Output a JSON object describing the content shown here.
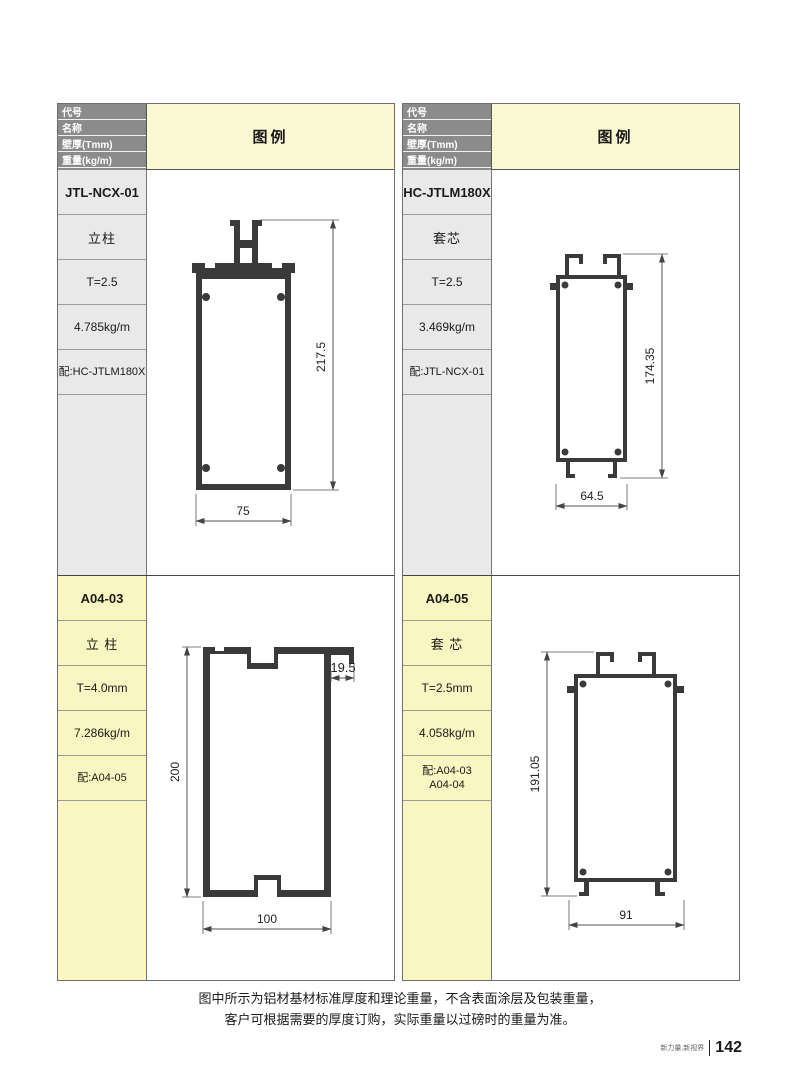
{
  "colors": {
    "header_gray": "#8b8b8b",
    "legend_yellow": "#FBF9D2",
    "cell_gray": "#e9e9e9",
    "cell_yellow": "#FAF6C2",
    "profile_ink": "#3a3a3a"
  },
  "header": {
    "rows": [
      "代号",
      "名称",
      "壁厚(Tmm)",
      "重量(kg/m)",
      "配套"
    ],
    "legend": "图例"
  },
  "panels": {
    "left": {
      "top": {
        "code": "JTL-NCX-01",
        "name": "立柱",
        "thickness": "T=2.5",
        "weight": "4.785kg/m",
        "match": "配:HC-JTLM180X",
        "dim_height": "217.5",
        "dim_width": "75"
      },
      "bottom": {
        "code": "A04-03",
        "name": "立 柱",
        "thickness": "T=4.0mm",
        "weight": "7.286kg/m",
        "match": "配:A04-05",
        "dim_height": "200",
        "dim_width": "100",
        "dim_lip": "19.5"
      }
    },
    "right": {
      "top": {
        "code": "HC-JTLM180X",
        "name": "套芯",
        "thickness": "T=2.5",
        "weight": "3.469kg/m",
        "match": "配:JTL-NCX-01",
        "dim_height": "174.35",
        "dim_width": "64.5"
      },
      "bottom": {
        "code": "A04-05",
        "name": "套 芯",
        "thickness": "T=2.5mm",
        "weight": "4.058kg/m",
        "match_line1": "配:A04-03",
        "match_line2": "A04-04",
        "dim_height": "191.05",
        "dim_width": "91"
      }
    }
  },
  "footer": {
    "note_line1": "图中所示为铝材基材标准厚度和理论重量，不含表面涂层及包装重量，",
    "note_line2": "客户可根据需要的厚度订购，实际重量以过磅时的重量为准。",
    "brand": "新力量,新视界",
    "page_number": "142"
  }
}
